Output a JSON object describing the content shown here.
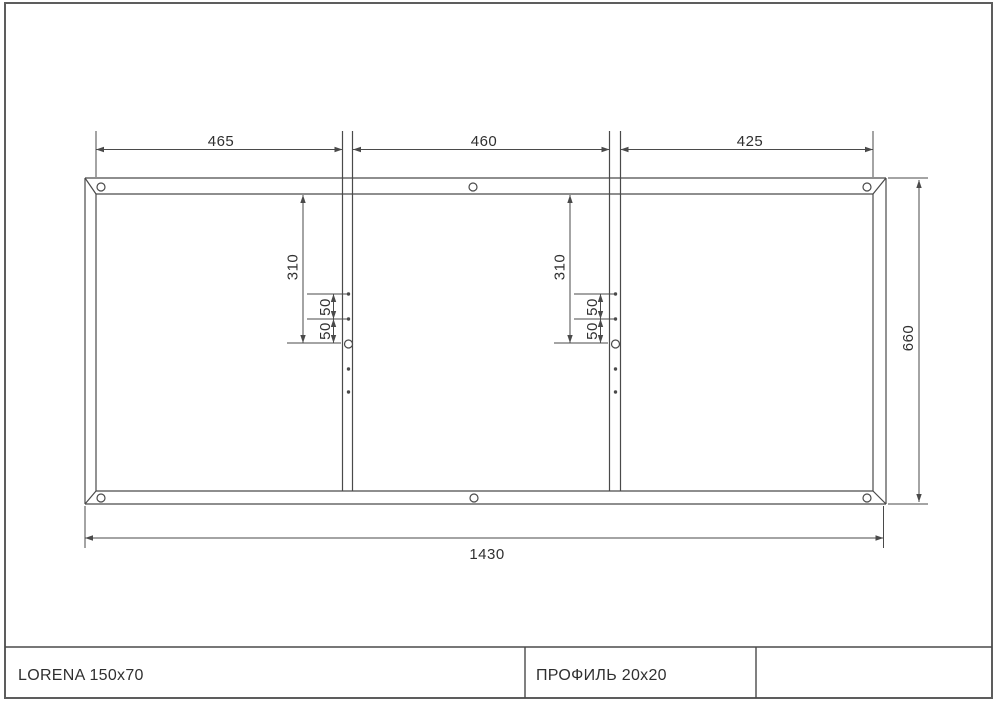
{
  "sheet": {
    "background": "#ffffff",
    "line_color": "#4a4a4a",
    "text_color": "#303030"
  },
  "drawing": {
    "type": "technical-frame-drawing",
    "dimensions": {
      "top_segments": [
        "465",
        "460",
        "425"
      ],
      "overall_width": "1430",
      "overall_height": "660",
      "member_hole_offset": "310",
      "hole_spacing": "50"
    }
  },
  "title_block": {
    "model": "LORENA 150x70",
    "profile": "ПРОФИЛЬ 20x20",
    "extra_cell": ""
  }
}
